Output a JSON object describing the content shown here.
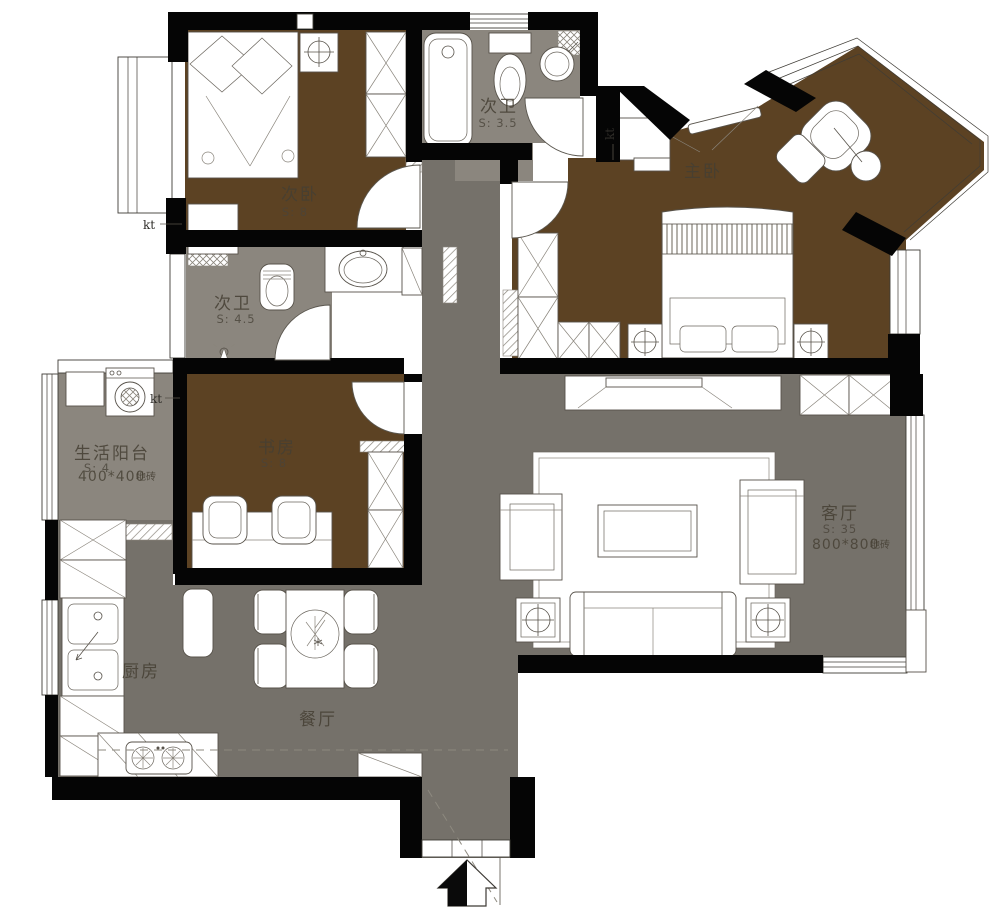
{
  "plan": {
    "kind": "apartment-floor-plan",
    "colors": {
      "floor_wood": "#5c4223",
      "floor_tile_main": "#75716a",
      "floor_tile_light": "#8b867e",
      "wall": "#050505",
      "background": "#ffffff"
    },
    "rooms": [
      {
        "key": "secondary-bedroom",
        "name": "次卧",
        "area": "S: 8"
      },
      {
        "key": "bath-top",
        "name": "次卫",
        "area": "S: 3.5"
      },
      {
        "key": "master-bedroom",
        "name": "主卧",
        "area": ""
      },
      {
        "key": "bath-mid",
        "name": "次卫",
        "area": "S: 4.5"
      },
      {
        "key": "utility-balcony",
        "name": "生活阳台",
        "area": "S: 4",
        "tile": "400*400",
        "tile_note": "地砖"
      },
      {
        "key": "study",
        "name": "书房",
        "area": "S: 8"
      },
      {
        "key": "living-room",
        "name": "客厅",
        "area": "S: 35",
        "tile": "800*800",
        "tile_note": "地砖"
      },
      {
        "key": "kitchen",
        "name": "厨房",
        "area": ""
      },
      {
        "key": "dining-room",
        "name": "餐厅",
        "area": ""
      }
    ],
    "annotations": {
      "ac_label": "kt"
    }
  }
}
